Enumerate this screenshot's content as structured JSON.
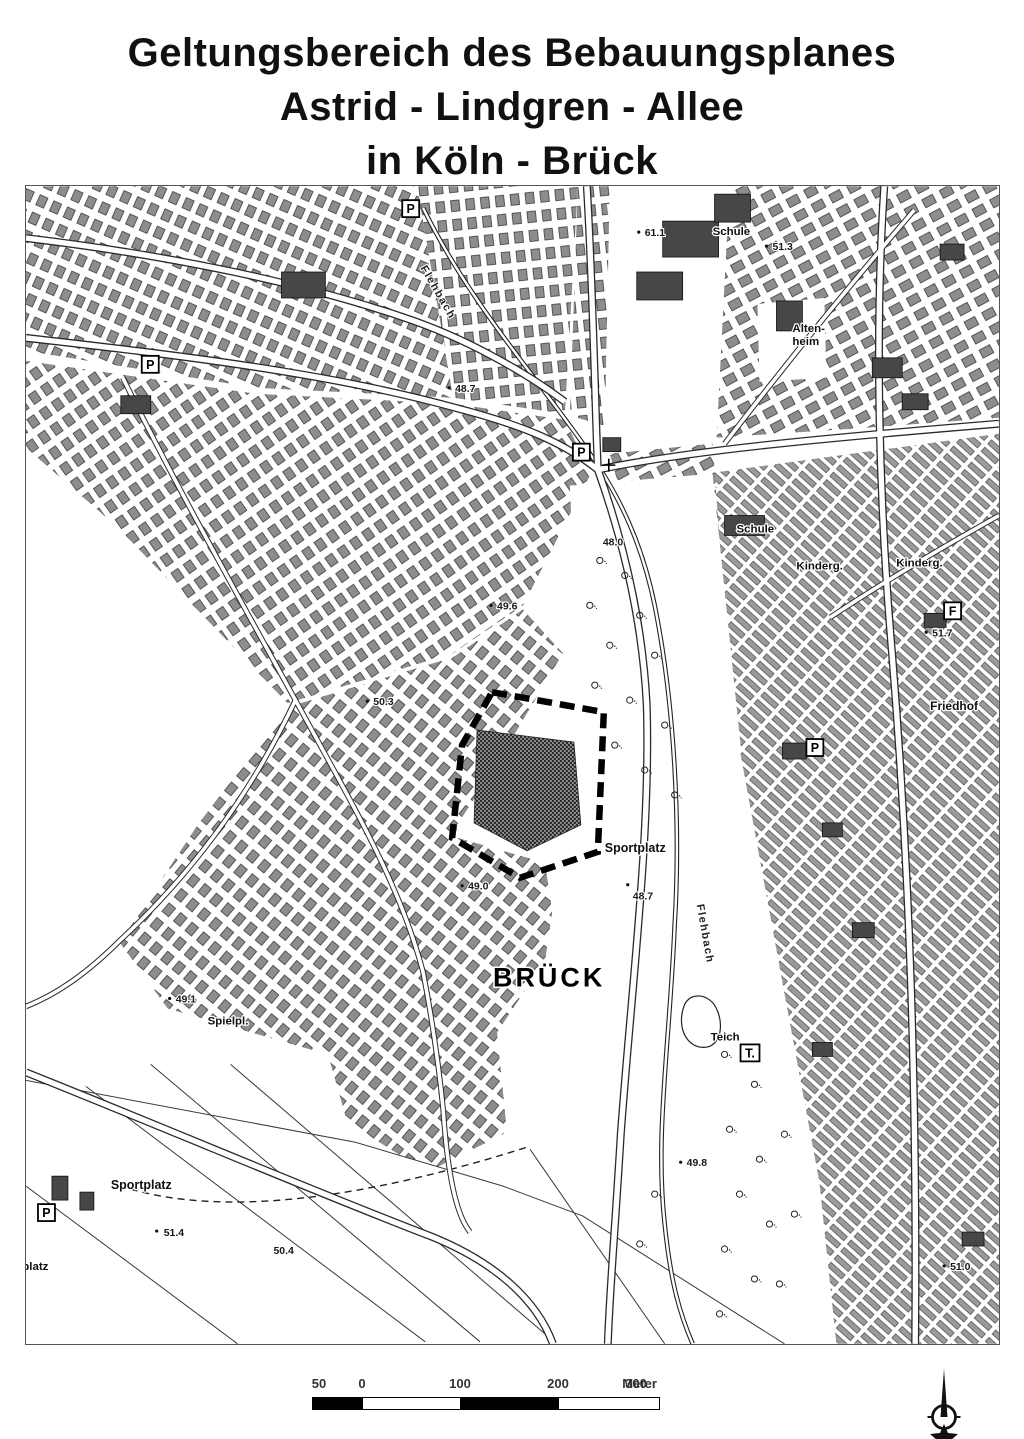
{
  "title": {
    "line1": "Geltungsbereich des Bebauungsplanes",
    "line2": "Astrid - Lindgren - Allee",
    "line3": "in Köln - Brück"
  },
  "map": {
    "place_labels": {
      "brueck": "BRÜCK",
      "schule_north": "Schule",
      "schule_center": "Schule",
      "altenheim_line1": "Alten-",
      "altenheim_line2": "heim",
      "kindergarten_west": "Kinderg.",
      "kindergarten_east": "Kinderg.",
      "friedhof": "Friedhof",
      "sportplatz_east": "Sportplatz",
      "sportplatz_southwest": "Sportplatz",
      "spielplatz": "Spielpl.",
      "bolzplatz": "Bolzplatz",
      "teich": "Teich",
      "flehbach_north": "Flehbach",
      "flehbach_south": "Flehbach"
    },
    "elevations": {
      "e611": "61.1",
      "e513": "51.3",
      "e487_north": "48.7",
      "e480": "48.0",
      "e496": "49.6",
      "e517": "51.7",
      "e503": "50.3",
      "e487_sportplatz": "48.7",
      "e490": "49.0",
      "e491": "49.1",
      "e514": "51.4",
      "e504": "50.4",
      "e498": "49.8",
      "e510": "51.0"
    },
    "symbols": {
      "parking": "P",
      "f_station": "F",
      "t_point": "T."
    }
  },
  "scalebar": {
    "ticks": [
      "50",
      "0",
      "100",
      "200",
      "300"
    ],
    "unit": "Meter"
  },
  "colors": {
    "ink": "#1a1a1a",
    "paper": "#ffffff",
    "building_gray": "#8a8a8a",
    "site_dark": "#2f2f2f"
  }
}
